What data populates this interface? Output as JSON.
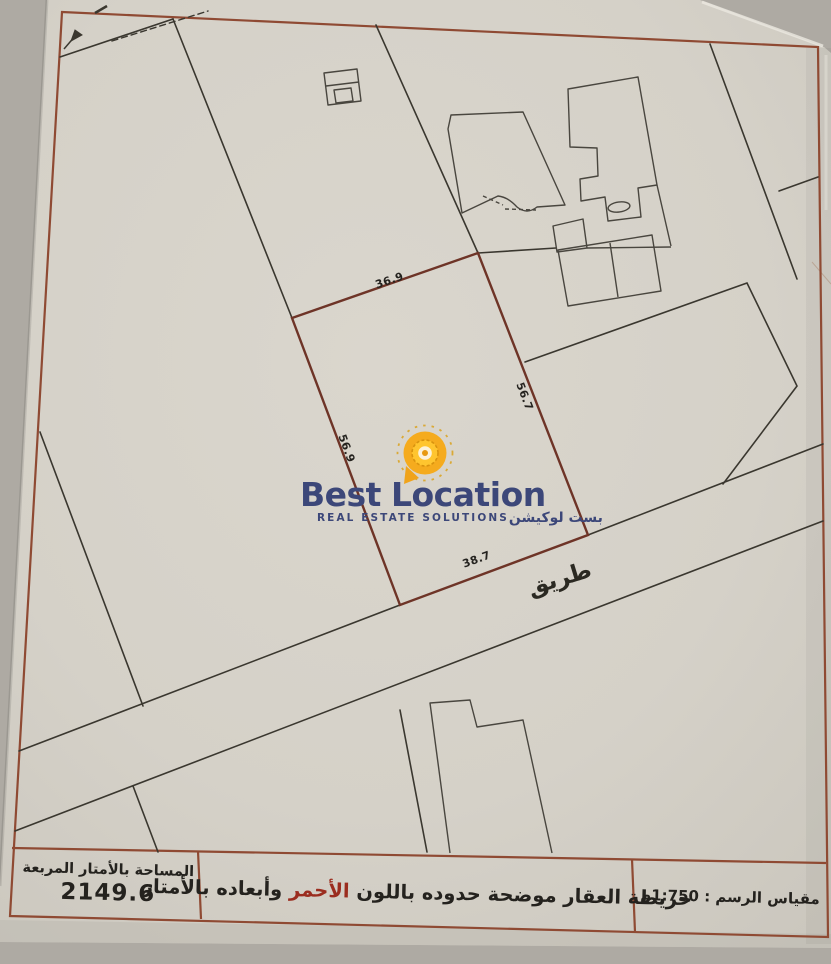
{
  "logo": {
    "word1": "Best",
    "word2": "Location",
    "tagline": "REAL ESTATE SOLUTIONS",
    "tagline_arabic": "بست لوكيشن"
  },
  "map": {
    "dimensions": {
      "top": "36.9",
      "right": "56.7",
      "left": "56.9",
      "bottom": "38.7"
    },
    "road_label": "طريق"
  },
  "footer": {
    "area_title": "المساحة بالأمتار المربعة",
    "area_value": "2149.6",
    "note_prefix": "خريطة العقار موضحة حدوده باللون",
    "note_highlight": "الأحمر",
    "note_suffix": "وأبعاده بالأمتار",
    "scale_text": "مقياس الرسم : 1:750م"
  },
  "colors": {
    "plot_outline_red": "#6e3427",
    "frame_red": "#8f4a33",
    "logo_navy": "#3c4779",
    "logo_amber": "#f5ab1e",
    "highlight_red": "#9b2d1f",
    "paper": "#d5d1c8"
  }
}
